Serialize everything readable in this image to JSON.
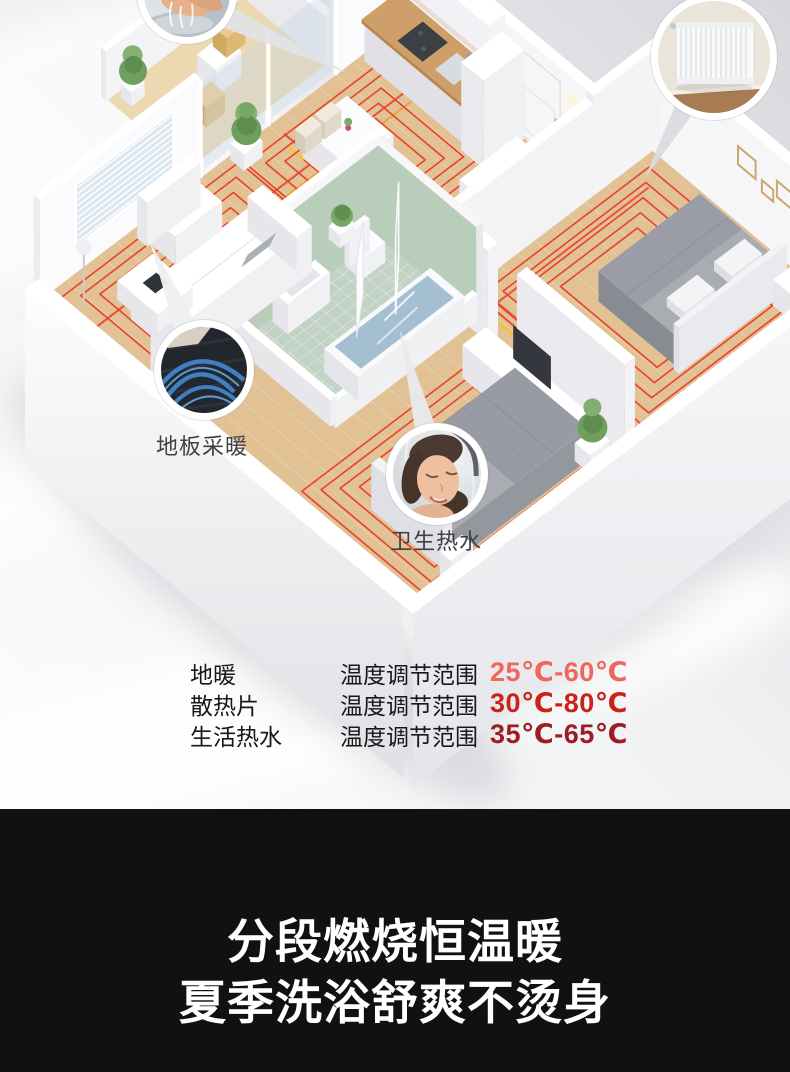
{
  "scene": {
    "labels": {
      "floor_heating": "地板采暖",
      "hot_water": "卫生热水"
    },
    "callouts": [
      "handwash-photo",
      "radiator-photo",
      "floor-heating-pipes-photo",
      "shower-photo"
    ],
    "colors": {
      "heating_coil": "#e8422c",
      "supply_red": "#e8422c",
      "supply_orange": "#ef9c2e",
      "supply_yellow": "#f2c71d",
      "wood_floor": "#e2c194",
      "bathroom_tile": "#c2d2c4",
      "pipe_blue": "#3f7fc3"
    }
  },
  "specs": {
    "rows": [
      {
        "name": "地暖",
        "label": "温度调节范围",
        "range": "25℃-60℃",
        "color": "#ee675c"
      },
      {
        "name": "散热片",
        "label": "温度调节范围",
        "range": "30℃-80℃",
        "color": "#cb2318"
      },
      {
        "name": "生活热水",
        "label": "温度调节范围",
        "range": "35℃-65℃",
        "color": "#9e1d22"
      }
    ]
  },
  "banner": {
    "line1": "分段燃烧恒温暖",
    "line2": "夏季洗浴舒爽不烫身"
  }
}
